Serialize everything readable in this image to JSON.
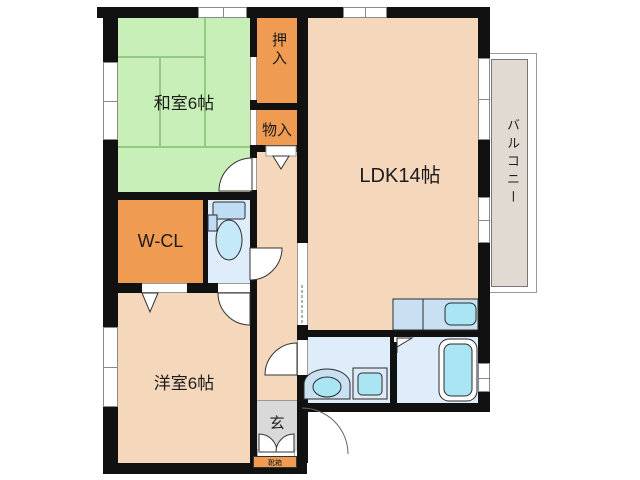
{
  "plan": {
    "rooms": {
      "washitsu": {
        "label": "和室6帖"
      },
      "oshiire": {
        "label": "押入"
      },
      "monoire": {
        "label": "物入"
      },
      "ldk": {
        "label": "LDK14帖"
      },
      "balcony": {
        "label": "バルコニー"
      },
      "wcl": {
        "label": "W-CL"
      },
      "youshitsu": {
        "label": "洋室6帖"
      },
      "genkan": {
        "label": "玄"
      },
      "shoebox": {
        "label": "靴箱"
      }
    },
    "fixtures": [
      "toilet",
      "washbasin",
      "washing-machine",
      "bathtub",
      "kitchen-sink"
    ],
    "colors": {
      "wall": "#111111",
      "tatami_green": "#C9EFB8",
      "tatami_line": "#93C983",
      "closet_orange": "#EF9B51",
      "room_peach": "#F5D8BC",
      "wet_area_blue": "#DEEDF9",
      "fixture_cyan": "#A9E5F2",
      "counter_blue": "#C9DFF2",
      "genkan_gray": "#D9D9D9",
      "balcony_beige": "#E0DAD3"
    }
  }
}
